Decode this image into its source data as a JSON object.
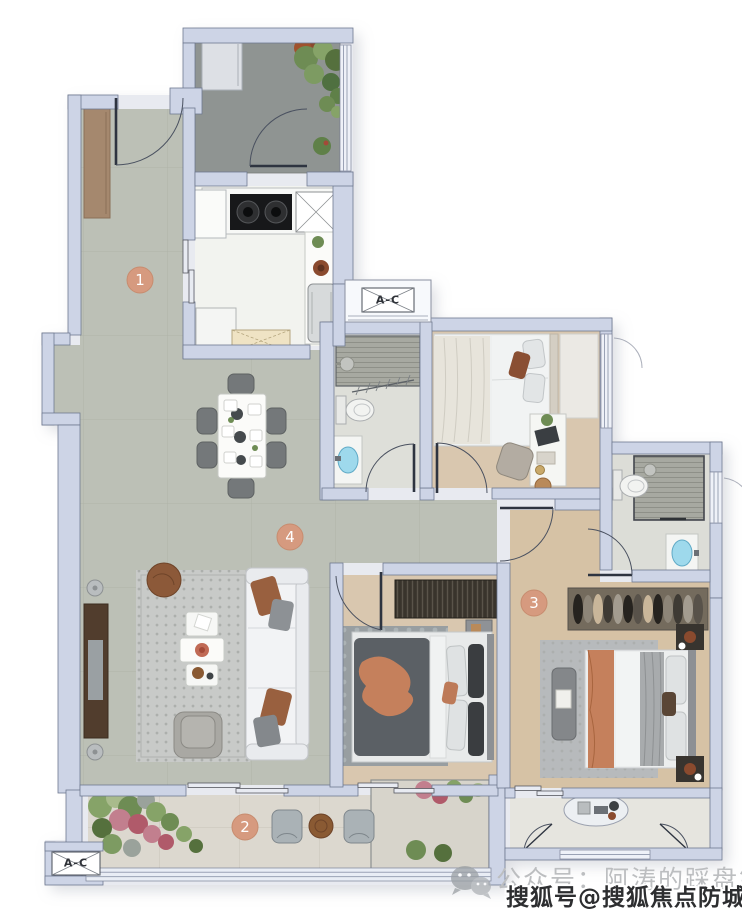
{
  "floor_plan": {
    "unit_markers": [
      {
        "label": "1"
      },
      {
        "label": "2"
      },
      {
        "label": "3"
      },
      {
        "label": "4"
      }
    ],
    "ac_labels": [
      {
        "text": "A-C"
      },
      {
        "text": "A-C"
      }
    ],
    "watermarks": {
      "wechat_caption": "公众号：阿涛的踩盘笔记",
      "sohu_caption": "搜狐号@搜狐焦点防城港站"
    },
    "colors": {
      "wall": "#cdd4e6",
      "wall_outline": "#6f7890",
      "marble_floor": "#bcc0b6",
      "wood_floor": "#d9c7af",
      "kitchen_floor": "#f2f3ef",
      "bath_floor": "#dedfd9",
      "patio_floor": "#8f9492",
      "balcony_floor": "#dcd8cf",
      "marker_accent": "#d69a7f",
      "throw_accent": "#c5805c",
      "basin_blue": "#9ed9ec",
      "watermark_gray": "#bcbec0",
      "watermark_dark": "#2d2e30"
    }
  }
}
